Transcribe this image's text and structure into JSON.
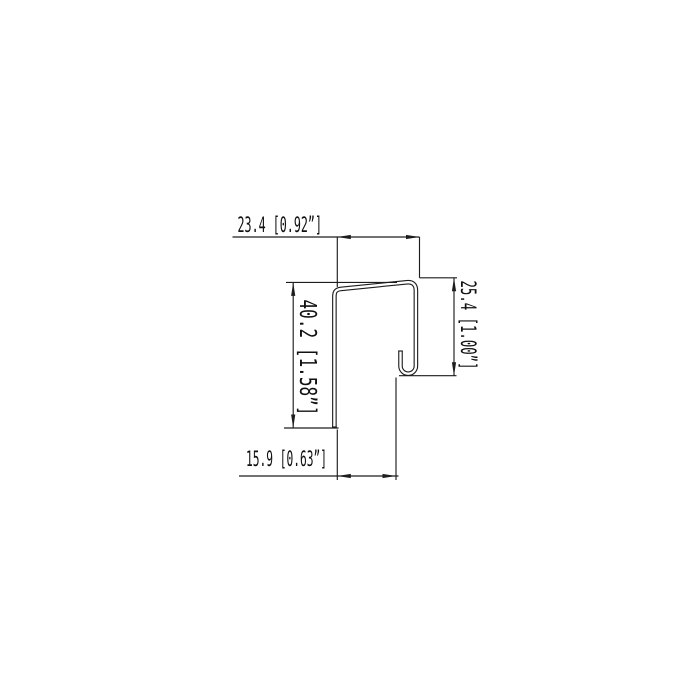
{
  "drawing": {
    "kind": "profile-cross-section-technical-drawing",
    "background": "#ffffff",
    "line_color": "#1d1d1d",
    "dims": {
      "top": {
        "label": "23.4 [0.92”]",
        "mm": 23.4,
        "inch": 0.92
      },
      "left": {
        "label": "40.2 [1.58”]",
        "mm": 40.2,
        "inch": 1.58
      },
      "right": {
        "label": "25.4 [1.00”]",
        "mm": 25.4,
        "inch": 1.0
      },
      "bottom": {
        "label": "15.9 [0.63”]",
        "mm": 15.9,
        "inch": 0.63
      }
    }
  }
}
